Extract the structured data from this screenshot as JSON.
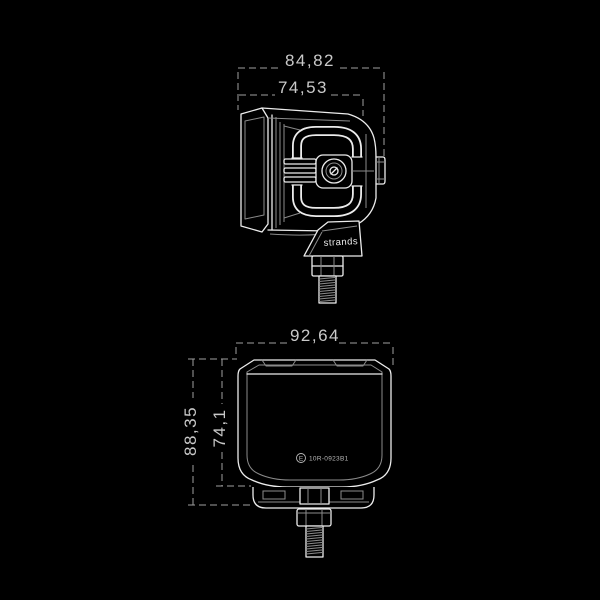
{
  "colors": {
    "background": "#000000",
    "line": "#ececec",
    "secondary_line": "#8b8b8b",
    "dimension_line": "#9f9f9f",
    "dimension_text": "#c9c9c9"
  },
  "views": {
    "side": {
      "dimensions": {
        "overall_depth": "84,82",
        "housing_depth": "74,53"
      },
      "brand_label": "strands"
    },
    "rear": {
      "dimensions": {
        "overall_width": "92,64",
        "overall_height": "88,35",
        "housing_height": "74,1"
      },
      "emark": {
        "letter": "E",
        "approval_number": "10R-0923B1"
      }
    }
  }
}
